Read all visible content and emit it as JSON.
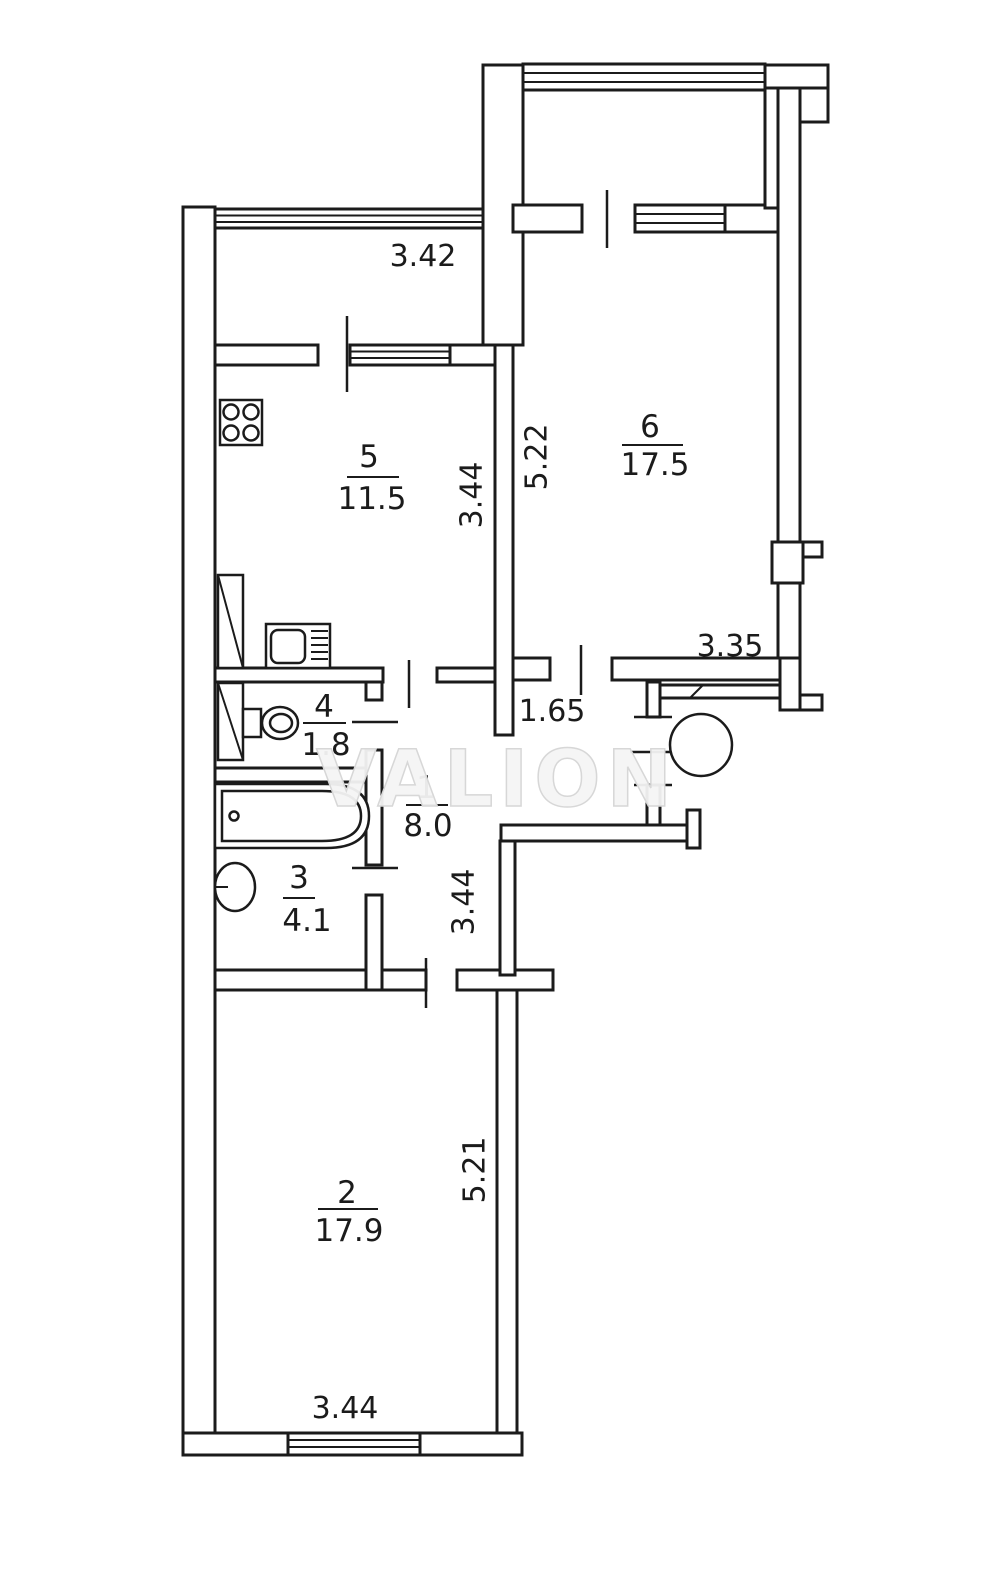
{
  "watermark": "VALION",
  "rooms": [
    {
      "number": "1",
      "area": "8.0"
    },
    {
      "number": "2",
      "area": "17.9"
    },
    {
      "number": "3",
      "area": "4.1"
    },
    {
      "number": "4",
      "area": "1.8"
    },
    {
      "number": "5",
      "area": "11.5"
    },
    {
      "number": "6",
      "area": "17.5"
    }
  ],
  "dimensions": {
    "kitchen_balcony_width": "3.42",
    "kitchen_depth": "3.44",
    "room6_depth": "5.22",
    "room6_width": "3.35",
    "vestibule_width": "1.65",
    "hallway_depth": "3.44",
    "room2_depth": "5.21",
    "room2_width": "3.44"
  },
  "colors": {
    "line": "#1b1b1b",
    "watermark_fill": "#f4f4f4"
  }
}
